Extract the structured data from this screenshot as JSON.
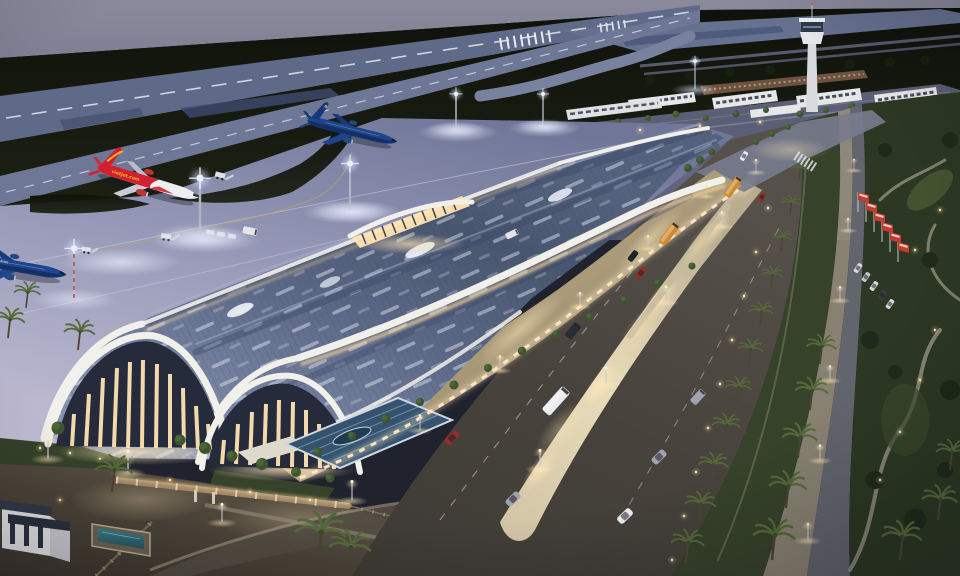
{
  "meta": {
    "description": "Aerial dusk rendering of a new airport: wave-roofed passenger terminal with glowing arched louver facades, apron with aircraft, runway and taxiway, control tower campus, palm-lined arrival boulevard and landscaped park",
    "time_of_day": "dusk"
  },
  "palette": {
    "sky-top": "#8b8a9c",
    "sky-low": "#525870",
    "field": "#12150e",
    "runway": "#5f6a88",
    "taxiway": "#6e7896",
    "marking": "#e6e9f2",
    "apron-far": "#6f7697",
    "apron-near": "#c2bed4",
    "roof-hi": "#8793b1",
    "roof-lo": "#49566f",
    "fascia": "#f2f0ea",
    "glow": "#ffd9a0",
    "glow-hot": "#ffe9c4",
    "louver": "#ffe3b2",
    "glass": "#232a39",
    "terrace-hi": "#d8c49c",
    "terrace-lo": "#7e7158",
    "road": "#47433c",
    "median": "#d6cbae",
    "walk": "#948c7a",
    "green": "#36422a",
    "park": "#2c3823",
    "path": "#a39c8d",
    "palm-leaf": "#55693a",
    "tower": "#d9dade",
    "cab": "#303848",
    "bldg": "#e7e7ea",
    "win": "#2b3140",
    "brick": "#6e5240",
    "campus": "#5b5f75",
    "wall": "#a18a69",
    "ground-hi": "#6a5f4f",
    "ground-lo": "#3a342c",
    "water": "#35737e",
    "flag": "#c23b2e",
    "bus": "#d08a2e",
    "white": "#e9ebee",
    "gray": "#9fa3ad",
    "dark": "#23242c",
    "red": "#8e2f28",
    "vj-red": "#d1202f",
    "vj-yellow": "#f7b32b",
    "vna-blue": "#1d448c",
    "vna-dark": "#142f63"
  },
  "aircraft": {
    "vietjet": {
      "airline": "VietJet Air",
      "label": "vietjet.com",
      "body": "#d1202f",
      "accent": "#f7b32b"
    },
    "vna": {
      "airline": "Vietnam Airlines",
      "label": "Vietnam Airlines",
      "body": "#1d448c"
    }
  },
  "airside": {
    "runway": "runway with threshold piano-key markings and dashed centerline",
    "taxiway": "parallel taxiway with dashed centerline",
    "apron": "floodlit terminal apron",
    "equipment": [
      "passenger stairs",
      "baggage dollies",
      "service vans"
    ],
    "floodlight_masts": 6
  },
  "terminal": {
    "name": "passenger terminal",
    "roof": "overlapping wave barrel vaults with skylight strips",
    "features": [
      "arched glass west ends",
      "warm glowing vertical louvers",
      "white wave fascias",
      "curbside drop-off canopy",
      "blue glass entrance canopy"
    ]
  },
  "landside": {
    "boulevard": {
      "lit_medians": 2,
      "lane_markings": "dashed",
      "street_lights": true
    },
    "vehicles": [
      {
        "type": "shuttle bus",
        "color": "#d08a2e"
      },
      {
        "type": "shuttle bus",
        "color": "#d08a2e"
      },
      {
        "type": "coach bus",
        "color": "#e9ebee"
      },
      {
        "type": "van",
        "color": "#23242c"
      },
      {
        "type": "minivan",
        "color": "#9fa3ad"
      },
      {
        "type": "car",
        "color": "#8e2f28"
      },
      {
        "type": "car",
        "color": "#8e2f28"
      },
      {
        "type": "car",
        "color": "#9fa3ad"
      },
      {
        "type": "car",
        "color": "#23242c"
      },
      {
        "type": "car",
        "color": "#e9ebee"
      },
      {
        "type": "car",
        "color": "#9fa3ad"
      },
      {
        "type": "car",
        "color": "#e9ebee"
      }
    ],
    "palm_rows": 2,
    "park": "landscaped park with winding paths and bollard lights",
    "flags": {
      "count": 6,
      "color": "#c23b2e"
    },
    "boundary": [
      "perimeter wall with lit piers",
      "entry gate",
      "guard house",
      "pool enclosure"
    ]
  },
  "campus": {
    "control_tower": 1,
    "buildings": 7,
    "crosswalk": true
  }
}
